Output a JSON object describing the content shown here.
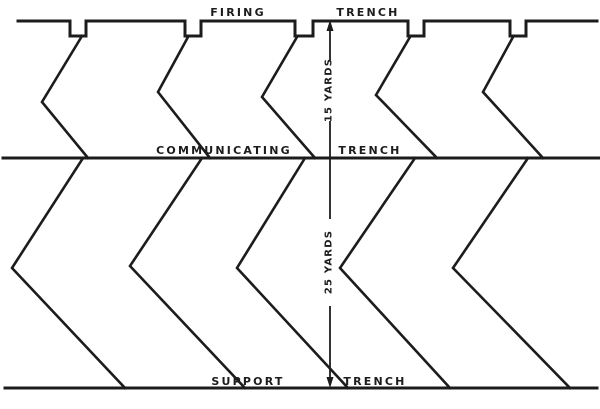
{
  "diagram": {
    "labels": {
      "firing": {
        "word1": "FIRING",
        "word2": "TRENCH"
      },
      "communicating": {
        "word1": "COMMUNICATING",
        "word2": "TRENCH"
      },
      "support": {
        "word1": "SUPPORT",
        "word2": "TRENCH"
      },
      "distance_firing_to_communicating": "15 YARDS",
      "distance_communicating_to_support": "25 YARDS"
    },
    "colors": {
      "ink": "#1c1c1c",
      "background": "#ffffff"
    }
  }
}
